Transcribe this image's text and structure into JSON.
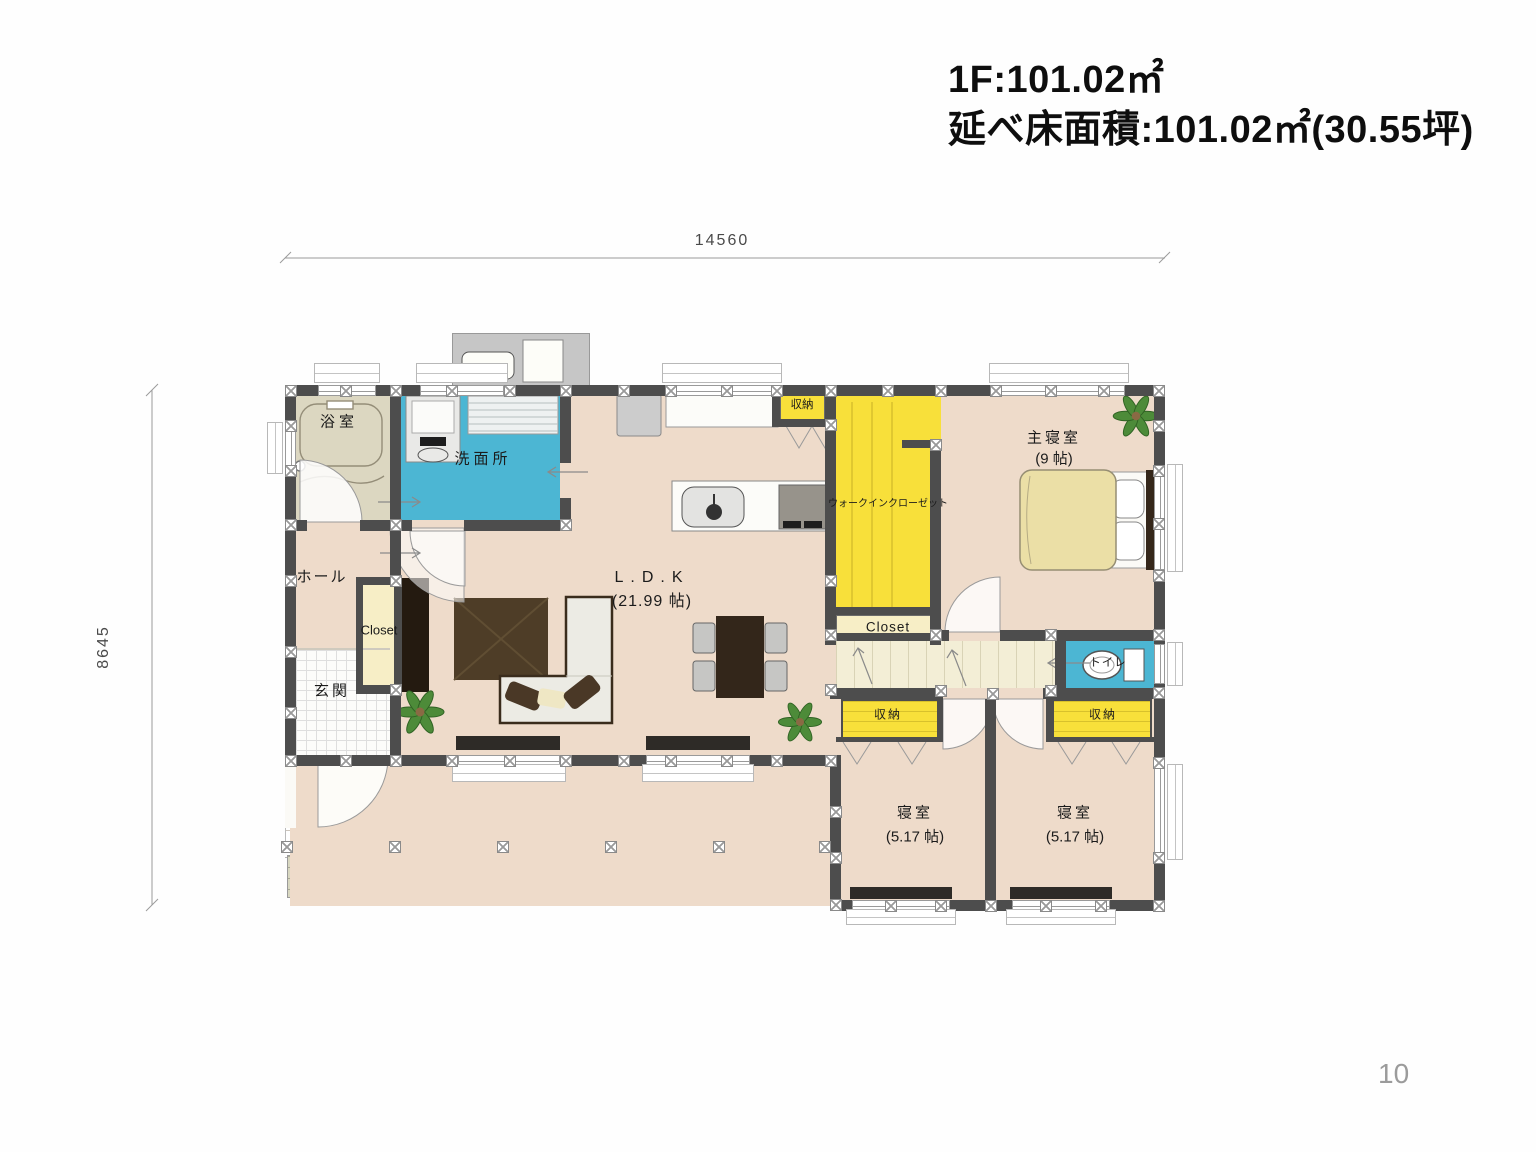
{
  "header": {
    "floor_area_line": "1F:101.02㎡",
    "total_area_line": "延べ床面積:101.02㎡(30.55坪)"
  },
  "dimensions": {
    "width_mm": "14560",
    "height_mm": "8645"
  },
  "rooms": {
    "bath": {
      "label": "浴室"
    },
    "washroom": {
      "label": "洗面所"
    },
    "hall": {
      "label": "ホール"
    },
    "entrance": {
      "label": "玄関"
    },
    "entrance_closet": {
      "label": "Closet"
    },
    "ldk": {
      "label": "L.D.K",
      "size": "(21.99 帖)"
    },
    "kitchen_storage": {
      "label": "収納"
    },
    "walk_in_closet": {
      "label": "ウォークインクローゼット"
    },
    "wic_closet": {
      "label": "Closet"
    },
    "master_bedroom": {
      "label": "主寝室",
      "size": "(9 帖)"
    },
    "toilet": {
      "label": "トイレ"
    },
    "bedroom1": {
      "label": "寝室",
      "size": "(5.17 帖)"
    },
    "bedroom1_storage": {
      "label": "収納"
    },
    "bedroom2": {
      "label": "寝室",
      "size": "(5.17 帖)"
    },
    "bedroom2_storage": {
      "label": "収納"
    }
  },
  "page_number": "10",
  "colors": {
    "wall": "#4d4d4d",
    "room_beige": "#eedbca",
    "bath_beige": "#dcd7c1",
    "wet_area_blue": "#4cb6d3",
    "closet_yellow": "#f8e03a",
    "closet_cream": "#f7eec6",
    "corridor_cream": "#f3eed6",
    "furniture_dark_brown": "#4e3d27",
    "plant_green": "#4d8b39"
  }
}
